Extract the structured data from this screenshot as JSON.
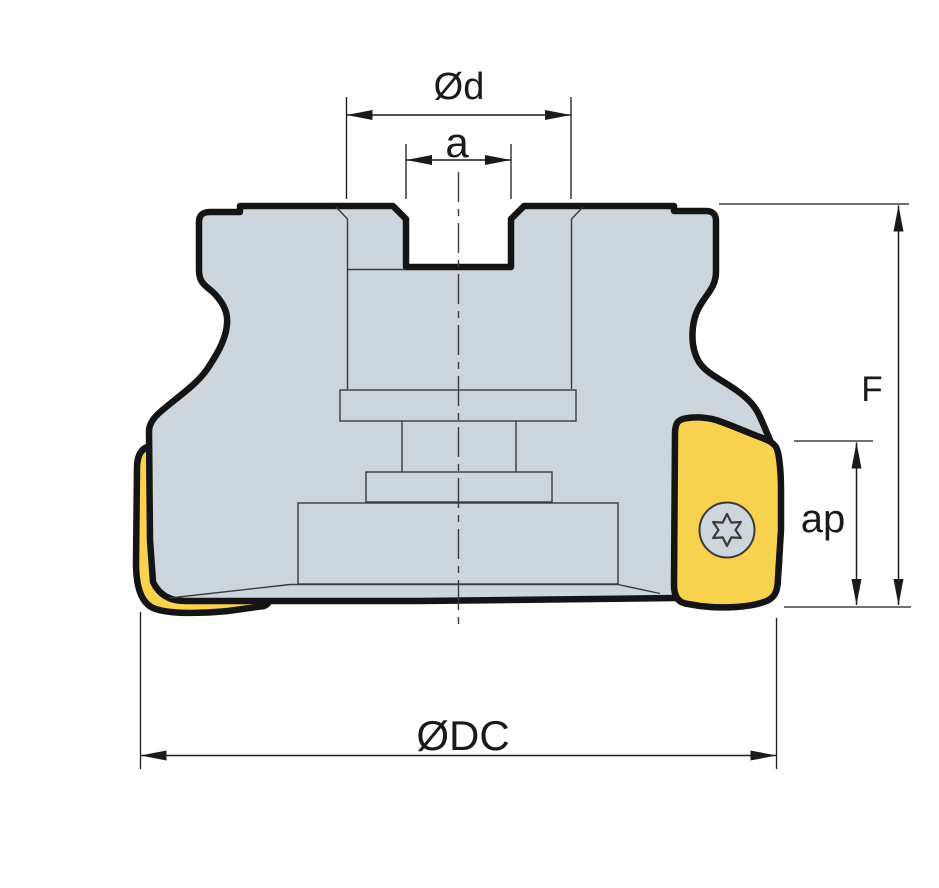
{
  "diagram": {
    "description": "Technical line drawing of a face milling cutter with indexable carbide inserts, front section view with dimension callouts",
    "view": "front-section",
    "labels": {
      "bore_diameter": "Ød",
      "drive_slot_width": "a",
      "height": "F",
      "max_depth_of_cut": "ap",
      "cutting_diameter": "ØDC"
    },
    "colors": {
      "background": "#ffffff",
      "body_fill": "#cdd6dd",
      "insert_fill": "#f9d24f",
      "outline": "#141414",
      "thin_line": "#3b3b3b",
      "dimension_line": "#1a1a1a",
      "text": "#1a1a1a"
    }
  }
}
